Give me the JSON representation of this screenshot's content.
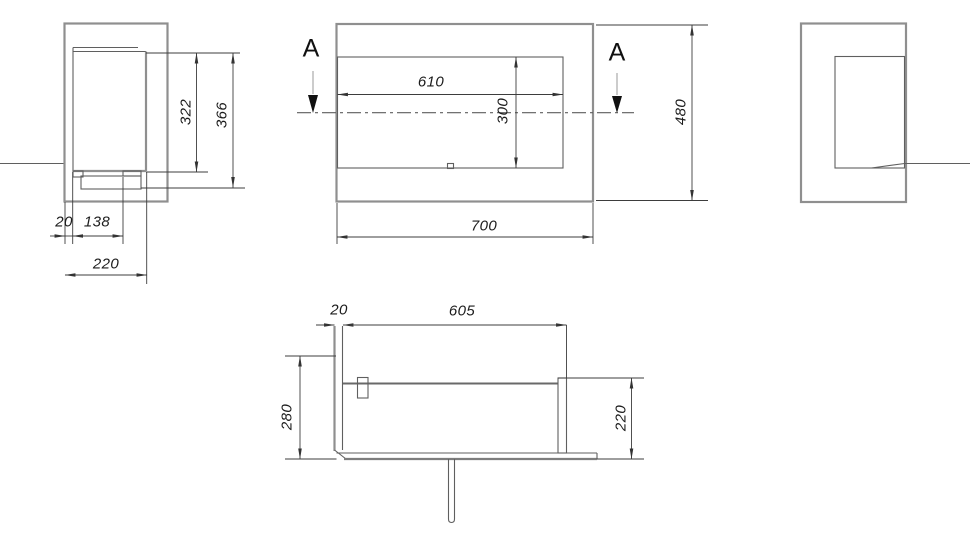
{
  "side_view_left": {
    "dim_inner_height": "322",
    "dim_overall_height": "366",
    "dim_wall_thickness": "20",
    "dim_inset": "138",
    "dim_depth": "220"
  },
  "front_view": {
    "section_letter_left": "A",
    "section_letter_right": "A",
    "dim_opening_width": "610",
    "dim_opening_height": "300",
    "dim_overall_width": "700",
    "dim_overall_height": "480"
  },
  "section_view": {
    "dim_wall_thickness": "20",
    "dim_inner_width": "605",
    "dim_left_height": "280",
    "dim_right_height": "220"
  },
  "colors": {
    "outline": "#8f8f8f",
    "detail_line": "#5f5f5f",
    "dimension_line": "#3d3d3d",
    "text": "#1c1c1c",
    "background": "#ffffff"
  }
}
